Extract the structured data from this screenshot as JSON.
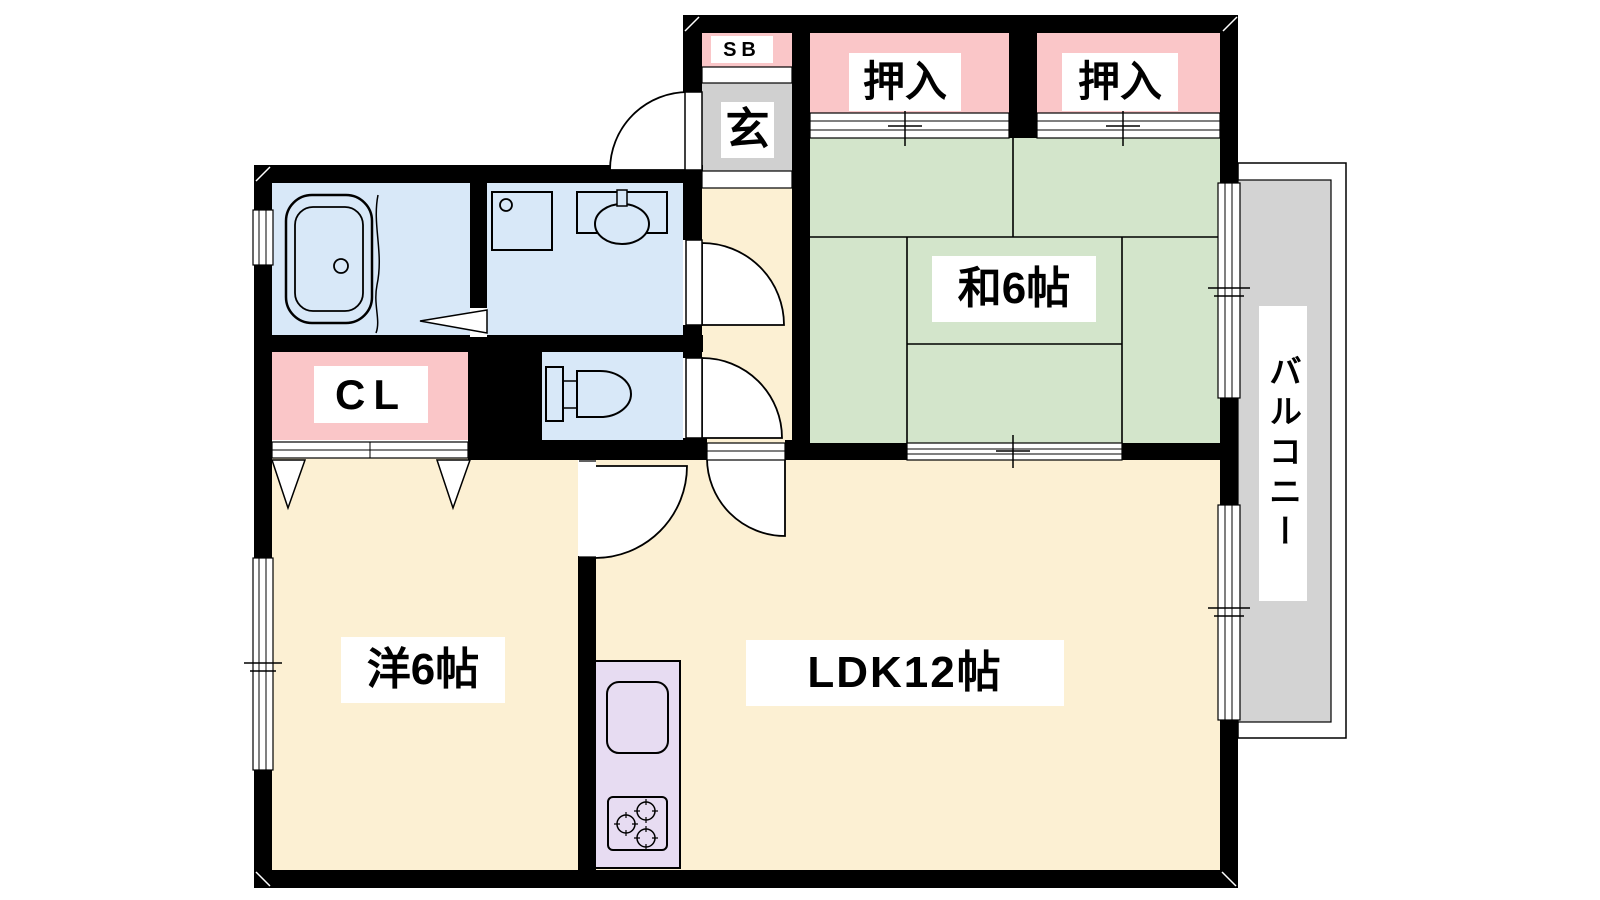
{
  "colors": {
    "wall": "#000000",
    "tatami_green": "#D3E5CB",
    "closet_pink": "#FAC6C8",
    "room_cream": "#FCF0D3",
    "wet_blue": "#D8E8F8",
    "genkan_gray": "#D0D0D0",
    "balcony_gray": "#D3D3D3",
    "kitchen_purple": "#E7DCF2",
    "label_bg": "#FFFFFF",
    "text": "#000000"
  },
  "rooms": {
    "shoe_box": {
      "label": "SB"
    },
    "genkan": {
      "label": "玄"
    },
    "closet_1": {
      "label": "押入"
    },
    "closet_2": {
      "label": "押入"
    },
    "japanese_room": {
      "label": "和6帖"
    },
    "closet_cl": {
      "label": "CL"
    },
    "western_room": {
      "label": "洋6帖"
    },
    "ldk": {
      "label": "LDK12帖"
    },
    "balcony": {
      "label": "バルコニー"
    }
  }
}
